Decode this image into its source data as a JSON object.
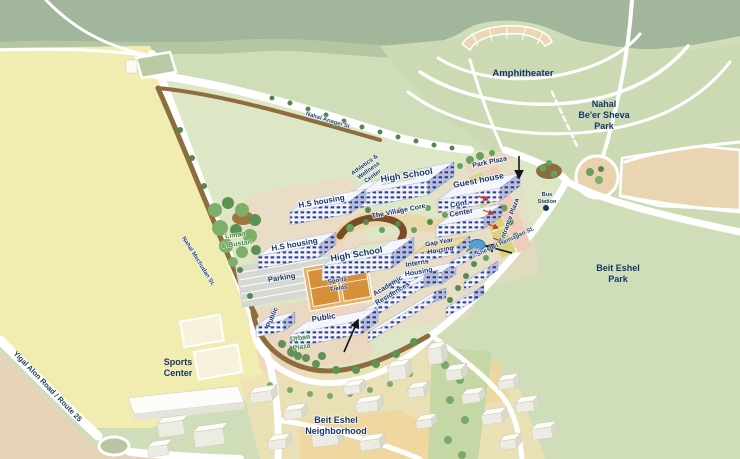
{
  "map_title": "Campus and park illustrated master plan",
  "labels": {
    "areas": {
      "amphitheater": "Amphitheater",
      "nahal_park_1": "Nahal",
      "nahal_park_2": "Be'er Sheva",
      "nahal_park_3": "Park",
      "beit_park_1": "Beit Eshel",
      "beit_park_2": "Park",
      "sports_center_1": "Sports",
      "sports_center_2": "Center",
      "neighborhood_1": "Beit Eshel",
      "neighborhood_2": "Neighborhood"
    },
    "campus": {
      "park_plaza": "Park Plaza",
      "guest_house": "Guest house",
      "conf_1": "Conf.",
      "conf_2": "Center",
      "high_school": "High School",
      "hs_housing": "H.S housing",
      "athletics_1": "Athletics &",
      "athletics_2": "Wellness",
      "athletics_3": "Center",
      "village_core": "The Village Core",
      "gap_1": "Gap Year",
      "gap_2": "Housing",
      "interns_1": "Interns",
      "interns_2": "Housing",
      "academic_1": "Academic",
      "academic_2": "Residences",
      "entrance_plaza": "Entrance Plaza",
      "bus_1": "Bus",
      "bus_2": "Station",
      "liman_1": "Liman",
      "liman_2": "& Bustan",
      "parking": "Parking",
      "sports_fields_1": "Sports",
      "sports_fields_2": "Fields",
      "public": "Public",
      "urban_1": "Urban",
      "urban_2": "Plaza"
    },
    "streets": {
      "nahal_anagei": "Nahal Anagei St.",
      "nahal_mechudan": "Nahal Mechudan St.",
      "sheshet_hamizgan": "Sheshet Hamizgan St.",
      "yigal_alon": "Yigal Alon Road / Route 25"
    }
  },
  "colors": {
    "label_navy": "#16356b",
    "label_green": "#3f8a3c",
    "berm_brown": "#8d6c3e",
    "field_yellow": "#f1ecb0",
    "sand_tan": "#e9d2ae",
    "pond_blue": "#4f9fd4",
    "court_orange": "#d88f3a"
  }
}
